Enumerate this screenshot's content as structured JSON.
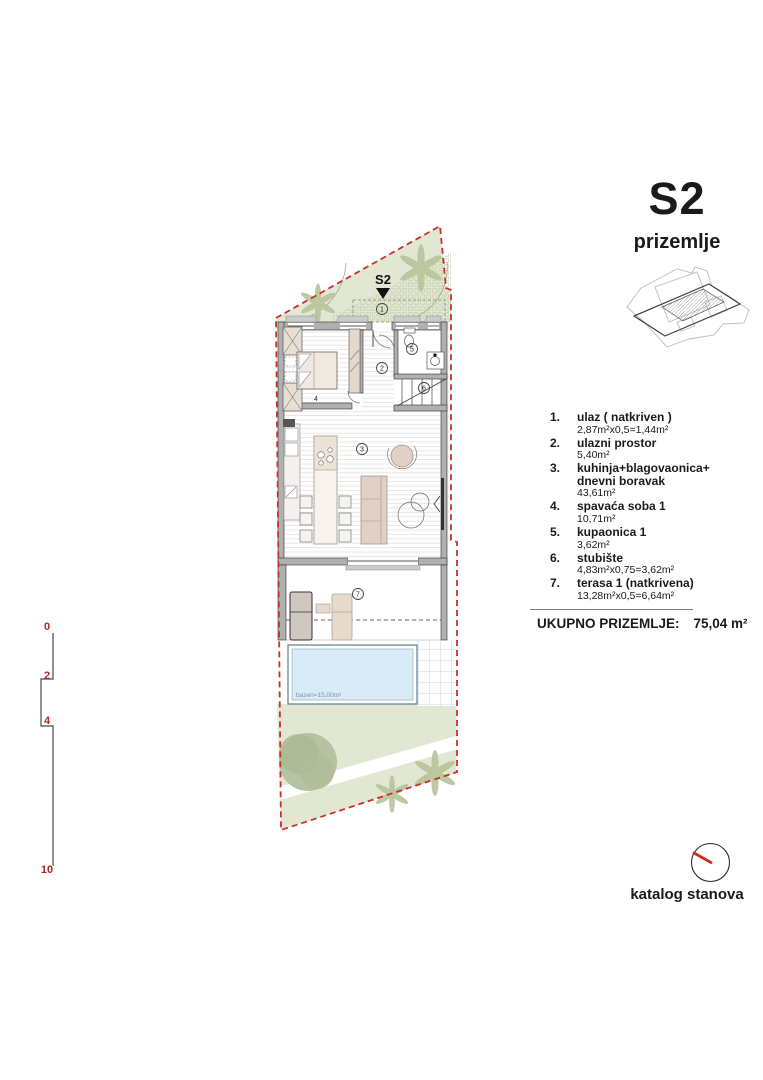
{
  "title": {
    "code": "S2",
    "floor": "prizemlje"
  },
  "colors": {
    "boundary_red": "#c9302b",
    "scale_red": "#b3251f",
    "compass_red": "#d02b20",
    "garden_green": "#e2e7d3",
    "pool_water": "#d9ebf6"
  },
  "plan": {
    "marker": "S2",
    "rooms": {
      "r1": "1",
      "r2": "2",
      "r3": "3",
      "r4": "4",
      "r5": "5",
      "r6": "6",
      "r7": "7"
    },
    "pool_label": "bazen=15,00m²"
  },
  "scalebar": {
    "ticks": [
      "0",
      "2",
      "4",
      "10"
    ]
  },
  "legend": {
    "items": [
      {
        "num": "1.",
        "name": "ulaz ( natkriven )",
        "area": "2,87m²x0,5=1,44m²"
      },
      {
        "num": "2.",
        "name": "ulazni prostor",
        "area": "5,40m²"
      },
      {
        "num": "3.",
        "name": "kuhinja+blagovaonica+\ndnevni boravak",
        "area": "43,61m²"
      },
      {
        "num": "4.",
        "name": "spavaća soba 1",
        "area": "10,71m²"
      },
      {
        "num": "5.",
        "name": "kupaonica 1",
        "area": "3,62m²"
      },
      {
        "num": "6.",
        "name": "stubište",
        "area": "4,83m²x0,75=3,62m²"
      },
      {
        "num": "7.",
        "name": "terasa 1 (natkrivena)",
        "area": "13,28m²x0,5=6,64m²"
      }
    ]
  },
  "total": {
    "label": "UKUPNO PRIZEMLJE:",
    "value": "75,04 m²"
  },
  "footer": {
    "label": "katalog stanova"
  }
}
